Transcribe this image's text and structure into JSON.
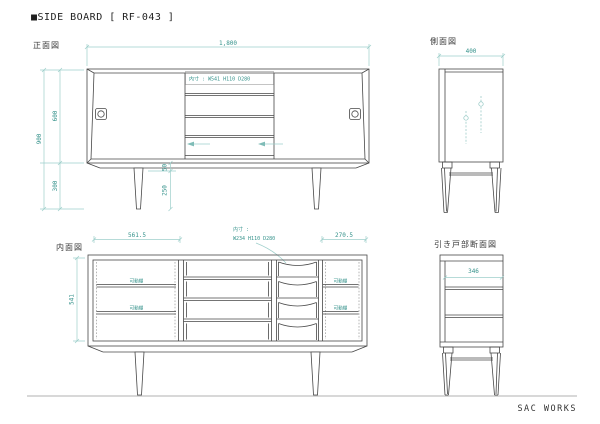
{
  "title": "■SIDE BOARD [ RF-043 ]",
  "footer": "SAC WORKS",
  "accent_color": "#35928b",
  "line_color": "#474747",
  "views": {
    "front": {
      "label": "正面図",
      "dim_width": "1,800",
      "dim_height_total": "900",
      "dim_height_body": "600",
      "dim_height_legs": "300",
      "dim_apron": "50",
      "dim_leg": "250",
      "inner_note": "内寸 : W541 H110 D280"
    },
    "side": {
      "label": "側面図",
      "dim_depth": "400"
    },
    "interior": {
      "label": "内面図",
      "dim_left_bay": "561.5",
      "dim_right_bay": "270.5",
      "dim_height": "541",
      "inner_note_line1": "内寸 :",
      "inner_note_line2": "W234 H110 D280",
      "shelf_label": "可動棚"
    },
    "section": {
      "label": "引き戸部断面図",
      "dim_inner_depth": "346"
    }
  }
}
